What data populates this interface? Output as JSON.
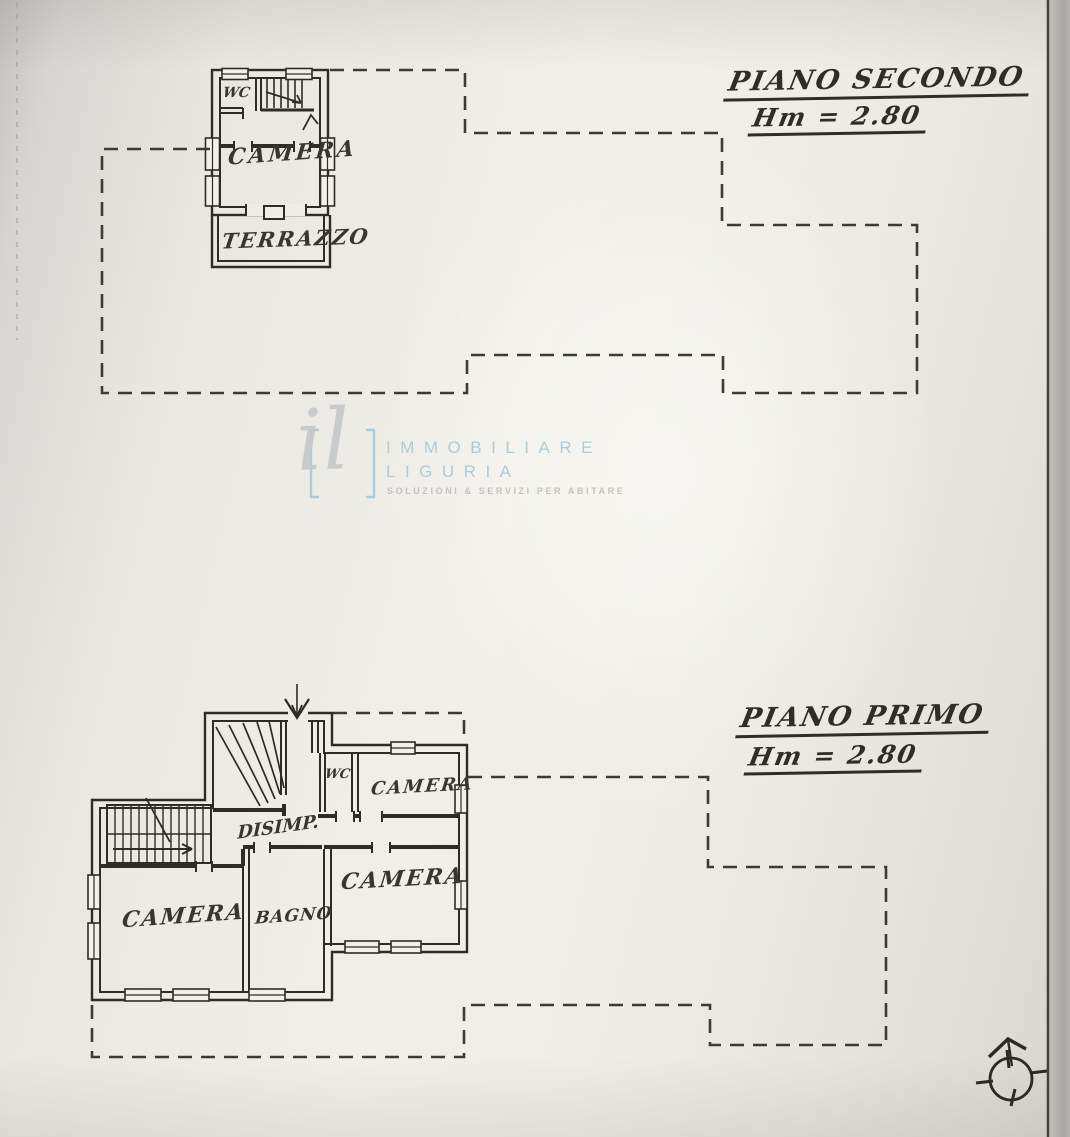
{
  "floor_second": {
    "title": "PIANO SECONDO",
    "height_label": "Hm = 2.80",
    "labels": {
      "wc": "WC",
      "camera": "CAMERA",
      "terrazzo": "TERRAZZO"
    }
  },
  "floor_first": {
    "title": "PIANO PRIMO",
    "height_label": "Hm = 2.80",
    "labels": {
      "wc": "WC",
      "camera_top": "CAMERA",
      "disimpegno": "DISIMP.",
      "camera_mid": "CAMERA",
      "camera_left": "CAMERA",
      "bagno": "BAGNO"
    }
  },
  "watermark": {
    "monogram": "il",
    "name_line1": "IMMOBILIARE",
    "name_line2": "LIGURIA",
    "tagline": "SOLUZIONI & SERVIZI PER ABITARE",
    "accent_color": "#aecbd9",
    "monogram_color": "#c5c7c9",
    "tagline_color": "#c3c2c0"
  },
  "icons": {
    "compass": "north-compass-icon",
    "entrance": "entrance-arrow-icon"
  },
  "colors": {
    "ink": "#2e2c28",
    "dash": "#3d3b36",
    "paper": "#efede7"
  }
}
